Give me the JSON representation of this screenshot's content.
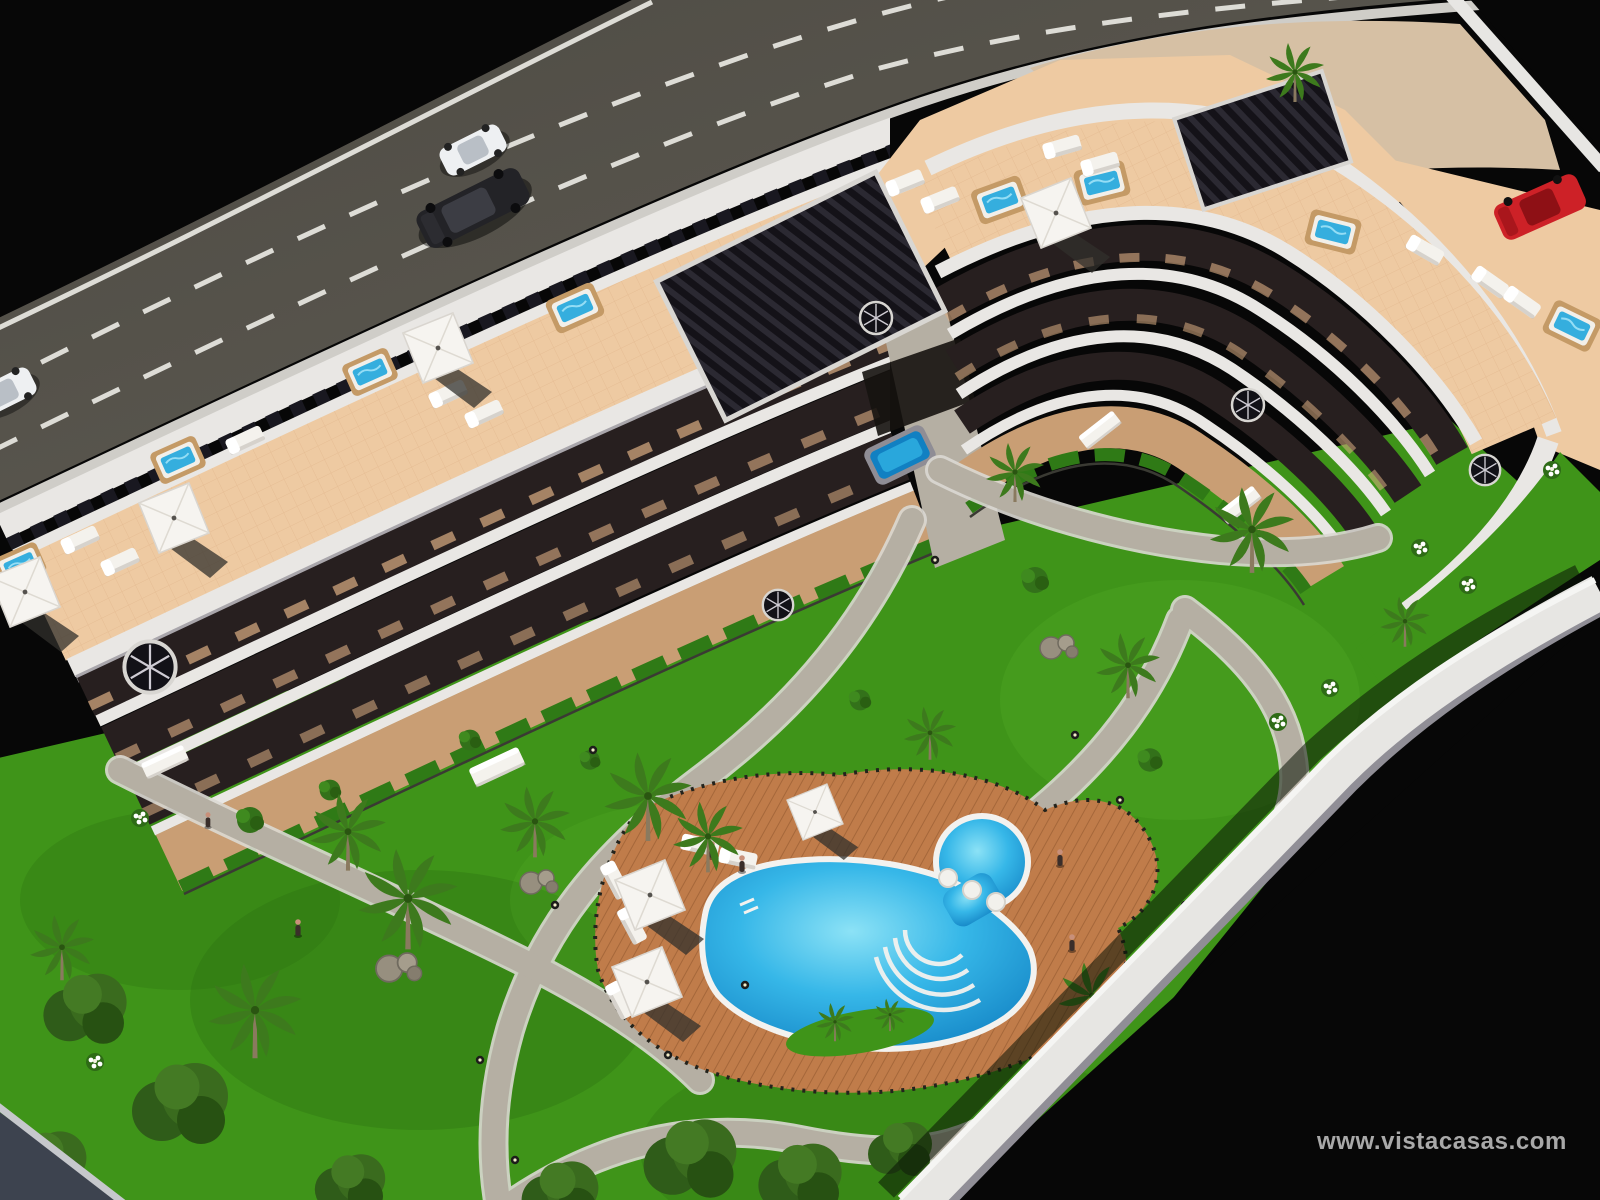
{
  "watermark": {
    "text": "www.vistacasas.com"
  },
  "scene": {
    "type": "aerial-3d-architectural-render",
    "subject": "curved white apartment complex with communal gardens and lagoon pool, viewed from above at night-black backdrop",
    "elements": [
      "asphalt road with dashed lane markings",
      "dark suv driving",
      "white car driving",
      "white car at left edge",
      "red car parked at right edge",
      "curved apartment building with roof terraces",
      "rooftop jacuzzis",
      "white parasols and sun loungers",
      "black slatted pergolas",
      "stepped balconies with dark interiors",
      "ground floor patios with hedges and fences",
      "spiral staircases",
      "courtyard garden with palm trees",
      "winding gray footpaths",
      "bollard lights",
      "rock clusters",
      "kidney shaped swimming pool with circular spa",
      "pool stools and curved steps",
      "timber pool deck with umbrellas",
      "white perimeter wall",
      "people figures"
    ]
  },
  "palette": {
    "bg": "#070707",
    "road": "#56534b",
    "roadLine": "#dddcd6",
    "curb": "#cfcdc8",
    "sand": "#d6c0a4",
    "bldg": "#e9e7e4",
    "bldgShade": "#a9a6ab",
    "slot": "#191820",
    "terrace": "#eecaa2",
    "terraceLine": "#dcae83",
    "pergola": "#141218",
    "voidDark": "#271f1f",
    "floorBrown": "#6e4a39",
    "groundTan": "#c99e74",
    "hedge": "#2f7a16",
    "grass": "#3f9419",
    "grassDark": "#2c7010",
    "grassLight": "#5cb52e",
    "palmGreen": "#3d7a1d",
    "palmOlive": "#7d8a55",
    "trunk": "#8a7a5f",
    "path": "#b5afa3",
    "pathEdge": "#dbd9d3",
    "rock": "#978f7f",
    "wall": "#e7e6e3",
    "wallShade": "#908e96",
    "wallDark": "#3d434f",
    "water": "#2fb0e2",
    "waterDeep": "#1180c2",
    "waterLight": "#8ce2f6",
    "woodRim": "#c49a66",
    "deck": "#c07c4a",
    "deckLine": "#a5673a",
    "furn": "#f4f2ed",
    "furnShade": "#c9c5be",
    "umbrella": "#f6f4f0",
    "carDark": "#202023",
    "carWhite": "#eef0f2",
    "carRed": "#cd2127",
    "watermark": "#b7b7b7"
  }
}
